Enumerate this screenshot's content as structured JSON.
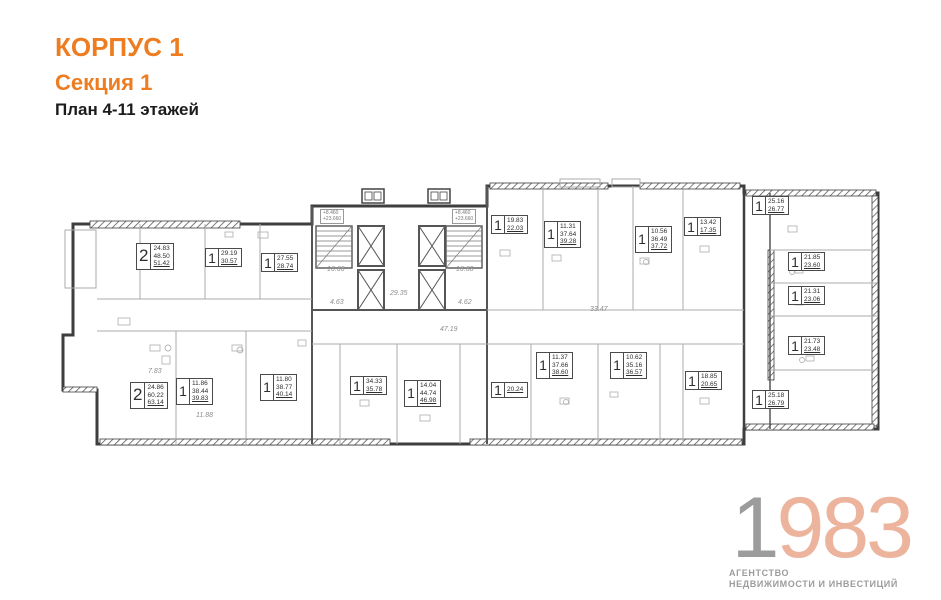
{
  "header": {
    "building": "КОРПУС 1",
    "section": "Секция 1",
    "plan_title": "План 4-11 этажей"
  },
  "plan": {
    "apartments": [
      {
        "type": "2",
        "areas": [
          "24.83",
          "48.50",
          "51.42"
        ]
      },
      {
        "type": "1",
        "areas": [
          "29.19",
          "30.57"
        ]
      },
      {
        "type": "1",
        "areas": [
          "27.55",
          "28.74"
        ]
      },
      {
        "type": "1",
        "areas": [
          "19.83",
          "22.03"
        ]
      },
      {
        "type": "1",
        "areas": [
          "11.31",
          "37.64",
          "39.28"
        ]
      },
      {
        "type": "1",
        "areas": [
          "10.56",
          "36.49",
          "37.72"
        ]
      },
      {
        "type": "1",
        "areas": [
          "13.42",
          "17.35"
        ]
      },
      {
        "type": "1",
        "areas": [
          "25.16",
          "26.77"
        ]
      },
      {
        "type": "1",
        "areas": [
          "21.85",
          "23.60"
        ]
      },
      {
        "type": "1",
        "areas": [
          "21.31",
          "23.06"
        ]
      },
      {
        "type": "1",
        "areas": [
          "21.73",
          "23.48"
        ]
      },
      {
        "type": "1",
        "areas": [
          "25.18",
          "26.79"
        ]
      },
      {
        "type": "1",
        "areas": [
          "18.85",
          "20.65"
        ]
      },
      {
        "type": "1",
        "areas": [
          "10.62",
          "35.16",
          "36.57"
        ]
      },
      {
        "type": "1",
        "areas": [
          "11.37",
          "37.66",
          "38.60"
        ]
      },
      {
        "type": "1",
        "areas": [
          "20.24"
        ]
      },
      {
        "type": "1",
        "areas": [
          "14.04",
          "44.74",
          "46.98"
        ]
      },
      {
        "type": "1",
        "areas": [
          "34.33",
          "35.78"
        ]
      },
      {
        "type": "1",
        "areas": [
          "11.80",
          "38.77",
          "40.14"
        ]
      },
      {
        "type": "1",
        "areas": [
          "11.86",
          "38.44",
          "39.83"
        ]
      },
      {
        "type": "2",
        "areas": [
          "24.86",
          "60.22",
          "63.14"
        ]
      }
    ],
    "annotations": [
      "16.66",
      "16.68",
      "29.35",
      "4.63",
      "4.62",
      "47.19",
      "33.47",
      "7.83",
      "11.88"
    ],
    "elevation_marks": [
      "+8.460",
      "+23.660"
    ]
  },
  "logo": {
    "year_first": "1",
    "year_rest": "983",
    "line1": "АГЕНТСТВО",
    "line2": "НЕДВИЖИМОСТИ И ИНВЕСТИЦИЙ"
  },
  "colors": {
    "accent_orange": "#ee7d21",
    "wall": "#3e3e3e",
    "thin_line": "#ababab",
    "logo_gray": "#9c9c9c",
    "logo_salmon": "#edb49d"
  }
}
